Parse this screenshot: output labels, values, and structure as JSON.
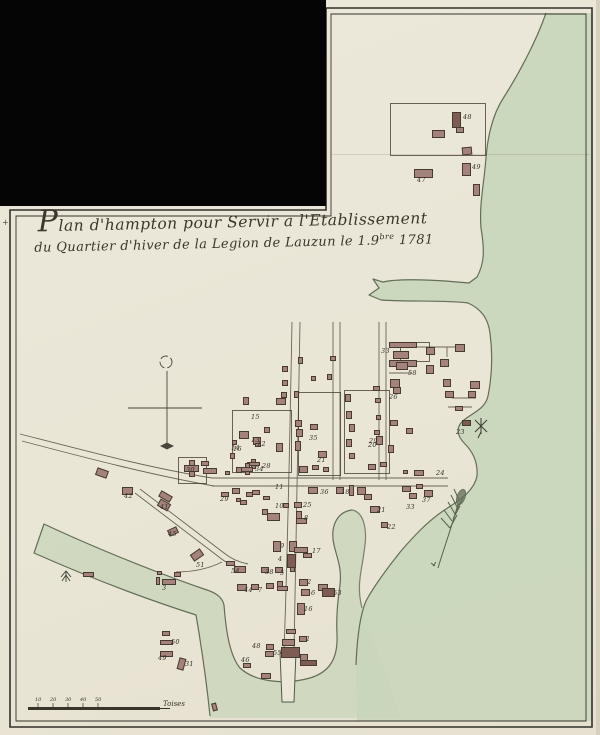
{
  "title": {
    "line1": "Plan d'hampton pour Servir a l'Etablissement",
    "line2a": "du Quartier d'hiver de la Legion de Lauzun le 1.9",
    "line2_sup": "bre",
    "line2b": " 1781"
  },
  "scale_bar": {
    "unit_label": "Toises",
    "ticks": [
      {
        "x": 38,
        "label": "10"
      },
      {
        "x": 53,
        "label": "20"
      },
      {
        "x": 68,
        "label": "30"
      },
      {
        "x": 83,
        "label": "40"
      },
      {
        "x": 98,
        "label": "50"
      }
    ]
  },
  "colors": {
    "paper": "#ebe7d8",
    "ink": "#3b352b",
    "frame": "#33302a",
    "water": "#c9d6ba",
    "shore": "#4e5943",
    "building": "#a3837b",
    "building_edge": "#473a31",
    "road": "#6a6458"
  },
  "map": {
    "plots": [
      [
        390,
        103,
        96,
        53
      ],
      [
        400,
        342,
        30,
        20
      ],
      [
        178,
        457,
        29,
        27
      ],
      [
        232,
        410,
        60,
        63
      ],
      [
        298,
        392,
        43,
        84
      ],
      [
        344,
        390,
        46,
        84
      ]
    ],
    "buildings": [
      [
        452,
        112,
        9,
        16,
        0,
        2
      ],
      [
        432,
        130,
        13,
        8,
        0,
        0
      ],
      [
        456,
        127,
        8,
        6,
        0,
        0
      ],
      [
        462,
        147,
        10,
        8,
        -5,
        0
      ],
      [
        414,
        169,
        19,
        9,
        0,
        0
      ],
      [
        462,
        163,
        9,
        13,
        0,
        0
      ],
      [
        473,
        184,
        7,
        12,
        0,
        0
      ],
      [
        389,
        342,
        28,
        6,
        0,
        0
      ],
      [
        393,
        351,
        16,
        8,
        0,
        0
      ],
      [
        389,
        360,
        28,
        7,
        0,
        0
      ],
      [
        426,
        347,
        9,
        8,
        0,
        0
      ],
      [
        455,
        344,
        10,
        8,
        0,
        0
      ],
      [
        440,
        359,
        9,
        8,
        0,
        0
      ],
      [
        426,
        365,
        8,
        9,
        0,
        0
      ],
      [
        396,
        362,
        12,
        8,
        0,
        0
      ],
      [
        390,
        379,
        10,
        9,
        0,
        0
      ],
      [
        393,
        387,
        8,
        7,
        0,
        0
      ],
      [
        443,
        379,
        8,
        8,
        0,
        0
      ],
      [
        470,
        381,
        10,
        8,
        0,
        0
      ],
      [
        445,
        391,
        9,
        7,
        0,
        0
      ],
      [
        468,
        391,
        8,
        7,
        0,
        0
      ],
      [
        455,
        406,
        8,
        5,
        0,
        0
      ],
      [
        462,
        420,
        9,
        6,
        0,
        2
      ],
      [
        373,
        386,
        7,
        5,
        0,
        0
      ],
      [
        375,
        398,
        6,
        5,
        0,
        0
      ],
      [
        376,
        415,
        5,
        5,
        0,
        0
      ],
      [
        374,
        430,
        6,
        5,
        0,
        0
      ],
      [
        390,
        420,
        8,
        6,
        0,
        0
      ],
      [
        406,
        428,
        7,
        6,
        0,
        0
      ],
      [
        388,
        445,
        6,
        8,
        0,
        0
      ],
      [
        282,
        366,
        6,
        6,
        0,
        0
      ],
      [
        282,
        380,
        6,
        6,
        0,
        0
      ],
      [
        281,
        392,
        6,
        6,
        0,
        0
      ],
      [
        276,
        398,
        10,
        7,
        0,
        0
      ],
      [
        298,
        357,
        5,
        7,
        0,
        0
      ],
      [
        311,
        376,
        5,
        5,
        0,
        0
      ],
      [
        327,
        374,
        5,
        6,
        0,
        0
      ],
      [
        330,
        356,
        6,
        5,
        0,
        0
      ],
      [
        243,
        397,
        6,
        8,
        0,
        0
      ],
      [
        239,
        431,
        10,
        8,
        0,
        0
      ],
      [
        253,
        437,
        8,
        8,
        0,
        0
      ],
      [
        230,
        453,
        5,
        6,
        0,
        0
      ],
      [
        276,
        443,
        7,
        9,
        0,
        0
      ],
      [
        247,
        459,
        13,
        10,
        0,
        1
      ],
      [
        236,
        467,
        6,
        6,
        0,
        0
      ],
      [
        264,
        427,
        6,
        6,
        0,
        0
      ],
      [
        294,
        391,
        5,
        7,
        0,
        0
      ],
      [
        295,
        420,
        7,
        7,
        0,
        0
      ],
      [
        296,
        429,
        7,
        8,
        0,
        0
      ],
      [
        310,
        424,
        8,
        6,
        0,
        0
      ],
      [
        295,
        441,
        6,
        10,
        0,
        0
      ],
      [
        318,
        451,
        9,
        7,
        0,
        0
      ],
      [
        299,
        466,
        9,
        7,
        0,
        0
      ],
      [
        312,
        465,
        7,
        5,
        0,
        0
      ],
      [
        323,
        467,
        6,
        5,
        0,
        0
      ],
      [
        345,
        394,
        6,
        8,
        0,
        0
      ],
      [
        346,
        411,
        6,
        8,
        0,
        0
      ],
      [
        349,
        424,
        6,
        8,
        0,
        0
      ],
      [
        346,
        439,
        6,
        8,
        0,
        0
      ],
      [
        349,
        453,
        6,
        6,
        0,
        0
      ],
      [
        376,
        436,
        7,
        9,
        0,
        0
      ],
      [
        368,
        464,
        8,
        6,
        0,
        0
      ],
      [
        380,
        462,
        7,
        5,
        0,
        0
      ],
      [
        414,
        470,
        10,
        6,
        0,
        0
      ],
      [
        403,
        470,
        5,
        4,
        0,
        0
      ],
      [
        402,
        486,
        9,
        6,
        0,
        0
      ],
      [
        416,
        484,
        7,
        5,
        0,
        0
      ],
      [
        409,
        493,
        8,
        6,
        0,
        0
      ],
      [
        424,
        490,
        9,
        7,
        0,
        0
      ],
      [
        370,
        506,
        10,
        7,
        0,
        0
      ],
      [
        381,
        522,
        7,
        6,
        0,
        0
      ],
      [
        308,
        487,
        10,
        7,
        0,
        0
      ],
      [
        336,
        487,
        8,
        7,
        0,
        0
      ],
      [
        349,
        485,
        5,
        11,
        0,
        0
      ],
      [
        357,
        487,
        9,
        8,
        0,
        0
      ],
      [
        364,
        494,
        8,
        6,
        0,
        0
      ],
      [
        294,
        502,
        8,
        6,
        0,
        0
      ],
      [
        283,
        503,
        6,
        5,
        0,
        0
      ],
      [
        296,
        511,
        6,
        13,
        0,
        0
      ],
      [
        296,
        518,
        11,
        6,
        0,
        0
      ],
      [
        232,
        488,
        8,
        6,
        0,
        0
      ],
      [
        252,
        490,
        8,
        5,
        0,
        0
      ],
      [
        263,
        496,
        7,
        4,
        0,
        0
      ],
      [
        240,
        500,
        7,
        5,
        0,
        0
      ],
      [
        262,
        509,
        6,
        6,
        0,
        0
      ],
      [
        267,
        513,
        13,
        8,
        0,
        0
      ],
      [
        273,
        541,
        8,
        11,
        0,
        0
      ],
      [
        289,
        541,
        8,
        11,
        0,
        0
      ],
      [
        294,
        547,
        14,
        6,
        0,
        0
      ],
      [
        303,
        553,
        9,
        5,
        0,
        0
      ],
      [
        287,
        554,
        9,
        14,
        0,
        2
      ],
      [
        261,
        567,
        8,
        6,
        0,
        0
      ],
      [
        275,
        567,
        8,
        6,
        0,
        0
      ],
      [
        290,
        567,
        5,
        5,
        0,
        0
      ],
      [
        237,
        584,
        10,
        7,
        0,
        0
      ],
      [
        251,
        584,
        8,
        6,
        0,
        0
      ],
      [
        266,
        583,
        8,
        6,
        0,
        0
      ],
      [
        277,
        581,
        6,
        10,
        0,
        0
      ],
      [
        277,
        586,
        11,
        5,
        0,
        0
      ],
      [
        299,
        579,
        9,
        7,
        0,
        0
      ],
      [
        301,
        589,
        9,
        7,
        0,
        0
      ],
      [
        318,
        584,
        10,
        7,
        0,
        0
      ],
      [
        322,
        588,
        13,
        9,
        0,
        2
      ],
      [
        297,
        603,
        8,
        12,
        0,
        0
      ],
      [
        299,
        636,
        8,
        6,
        0,
        0
      ],
      [
        286,
        629,
        10,
        5,
        0,
        0
      ],
      [
        282,
        639,
        13,
        7,
        0,
        0
      ],
      [
        266,
        644,
        8,
        6,
        0,
        0
      ],
      [
        265,
        651,
        9,
        6,
        0,
        0
      ],
      [
        281,
        647,
        19,
        11,
        0,
        2
      ],
      [
        300,
        654,
        8,
        12,
        0,
        0
      ],
      [
        300,
        660,
        17,
        6,
        0,
        2
      ],
      [
        243,
        663,
        8,
        5,
        0,
        0
      ],
      [
        261,
        673,
        10,
        6,
        0,
        0
      ],
      [
        212,
        703,
        5,
        8,
        -15,
        0
      ],
      [
        184,
        460,
        15,
        17,
        0,
        1
      ],
      [
        201,
        461,
        8,
        5,
        0,
        0
      ],
      [
        203,
        468,
        14,
        6,
        0,
        0
      ],
      [
        225,
        471,
        5,
        4,
        0,
        0
      ],
      [
        241,
        463,
        12,
        12,
        0,
        1
      ],
      [
        232,
        440,
        5,
        5,
        0,
        0
      ],
      [
        255,
        443,
        6,
        4,
        0,
        0
      ],
      [
        96,
        469,
        12,
        8,
        20,
        0
      ],
      [
        122,
        487,
        11,
        8,
        0,
        0
      ],
      [
        159,
        493,
        13,
        7,
        30,
        0
      ],
      [
        158,
        501,
        12,
        8,
        30,
        0
      ],
      [
        168,
        528,
        10,
        7,
        -25,
        0
      ],
      [
        191,
        551,
        12,
        8,
        -35,
        0
      ],
      [
        226,
        561,
        9,
        5,
        0,
        0
      ],
      [
        234,
        566,
        12,
        7,
        0,
        0
      ],
      [
        221,
        492,
        8,
        5,
        0,
        0
      ],
      [
        236,
        498,
        5,
        4,
        0,
        0
      ],
      [
        246,
        492,
        7,
        5,
        0,
        0
      ],
      [
        83,
        572,
        11,
        5,
        0,
        0
      ],
      [
        157,
        571,
        5,
        4,
        0,
        0
      ],
      [
        156,
        577,
        4,
        8,
        0,
        0
      ],
      [
        162,
        579,
        14,
        6,
        0,
        0
      ],
      [
        174,
        572,
        7,
        5,
        0,
        0
      ],
      [
        162,
        631,
        8,
        5,
        0,
        0
      ],
      [
        160,
        640,
        13,
        5,
        0,
        0
      ],
      [
        160,
        651,
        13,
        6,
        0,
        0
      ],
      [
        178,
        658,
        7,
        12,
        15,
        0
      ]
    ],
    "labels": [
      {
        "t": "48",
        "x": 463,
        "y": 114
      },
      {
        "t": "47",
        "x": 417,
        "y": 177
      },
      {
        "t": "49",
        "x": 472,
        "y": 164
      },
      {
        "t": "33",
        "x": 381,
        "y": 348
      },
      {
        "t": "58",
        "x": 408,
        "y": 370
      },
      {
        "t": "26",
        "x": 389,
        "y": 394
      },
      {
        "t": "20",
        "x": 368,
        "y": 442
      },
      {
        "t": "23",
        "x": 456,
        "y": 429
      },
      {
        "t": "15",
        "x": 251,
        "y": 414
      },
      {
        "t": "13",
        "x": 251,
        "y": 437
      },
      {
        "t": "14",
        "x": 231,
        "y": 445
      },
      {
        "t": "28",
        "x": 262,
        "y": 463
      },
      {
        "t": "35",
        "x": 309,
        "y": 435
      },
      {
        "t": "21",
        "x": 317,
        "y": 457
      },
      {
        "t": "29",
        "x": 369,
        "y": 438
      },
      {
        "t": "24",
        "x": 436,
        "y": 470
      },
      {
        "t": "36",
        "x": 320,
        "y": 489
      },
      {
        "t": "18",
        "x": 341,
        "y": 489
      },
      {
        "t": "37",
        "x": 422,
        "y": 497
      },
      {
        "t": "33",
        "x": 406,
        "y": 504
      },
      {
        "t": "25",
        "x": 303,
        "y": 502
      },
      {
        "t": "10",
        "x": 275,
        "y": 503
      },
      {
        "t": "8",
        "x": 304,
        "y": 515
      },
      {
        "t": "21",
        "x": 377,
        "y": 507
      },
      {
        "t": "22",
        "x": 387,
        "y": 524
      },
      {
        "t": "11",
        "x": 275,
        "y": 484
      },
      {
        "t": "16",
        "x": 233,
        "y": 446
      },
      {
        "t": "12",
        "x": 257,
        "y": 441
      },
      {
        "t": "30",
        "x": 186,
        "y": 467
      },
      {
        "t": "34",
        "x": 255,
        "y": 466
      },
      {
        "t": "42",
        "x": 124,
        "y": 493
      },
      {
        "t": "41",
        "x": 160,
        "y": 504
      },
      {
        "t": "45",
        "x": 168,
        "y": 531
      },
      {
        "t": "51",
        "x": 196,
        "y": 562
      },
      {
        "t": "54",
        "x": 231,
        "y": 568
      },
      {
        "t": "29",
        "x": 220,
        "y": 496
      },
      {
        "t": "3",
        "x": 162,
        "y": 585
      },
      {
        "t": "9",
        "x": 280,
        "y": 543
      },
      {
        "t": "17",
        "x": 312,
        "y": 548
      },
      {
        "t": "4",
        "x": 278,
        "y": 556
      },
      {
        "t": "38",
        "x": 265,
        "y": 569
      },
      {
        "t": "5",
        "x": 280,
        "y": 570
      },
      {
        "t": "44",
        "x": 244,
        "y": 587
      },
      {
        "t": "7",
        "x": 258,
        "y": 587
      },
      {
        "t": "2",
        "x": 307,
        "y": 579
      },
      {
        "t": "6",
        "x": 311,
        "y": 590
      },
      {
        "t": "53",
        "x": 333,
        "y": 590
      },
      {
        "t": "16",
        "x": 304,
        "y": 606
      },
      {
        "t": "1",
        "x": 306,
        "y": 636
      },
      {
        "t": "48",
        "x": 252,
        "y": 643
      },
      {
        "t": "55",
        "x": 273,
        "y": 650
      },
      {
        "t": "46",
        "x": 241,
        "y": 657
      },
      {
        "t": "50",
        "x": 171,
        "y": 639
      },
      {
        "t": "49",
        "x": 158,
        "y": 655
      },
      {
        "t": "31",
        "x": 185,
        "y": 661
      }
    ]
  }
}
